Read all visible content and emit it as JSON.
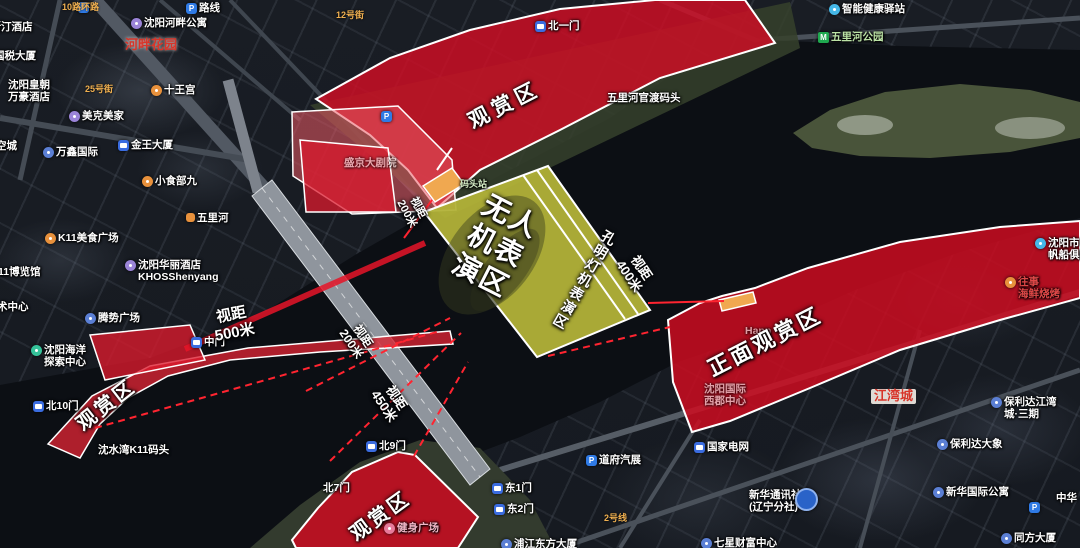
{
  "colors": {
    "viewing_zone_red": "#d20e24",
    "performance_zone_yellow": "#b2b238",
    "sight_line_red": "#ff2430",
    "dock_orange": "#f0a850",
    "red_place_label": "#d8352a"
  },
  "overlay_labels": [
    {
      "name": "viewing-area-top-label",
      "lines": [
        "观赏区"
      ],
      "x": 505,
      "y": 106,
      "rot": -27,
      "size": 21,
      "ls": 5
    },
    {
      "name": "front-viewing-area-label",
      "lines": [
        "正面观赏区"
      ],
      "x": 765,
      "y": 342,
      "rot": -27,
      "size": 22,
      "ls": 3
    },
    {
      "name": "viewing-area-bottom-left-label",
      "lines": [
        "观赏区"
      ],
      "x": 107,
      "y": 406,
      "rot": -38,
      "size": 20,
      "ls": 3
    },
    {
      "name": "viewing-area-bottom-center-label",
      "lines": [
        "观赏区"
      ],
      "x": 381,
      "y": 517,
      "rot": -36,
      "size": 20,
      "ls": 3
    },
    {
      "name": "drone-performance-zone-label",
      "lines": [
        "无人",
        "机表",
        "演区"
      ],
      "x": 496,
      "y": 246,
      "rot": 27,
      "size": 28,
      "ls": 2
    },
    {
      "name": "lantern-performance-zone-label",
      "lines": [
        "孔明灯机表演区"
      ],
      "x": 584,
      "y": 280,
      "rot": 30,
      "size": 14,
      "ls": 2,
      "vert": true
    },
    {
      "name": "sight-distance-500",
      "lines": [
        "视距",
        "500米"
      ],
      "x": 233,
      "y": 324,
      "rot": -11,
      "size": 15
    },
    {
      "name": "sight-distance-200-top",
      "lines": [
        "视距",
        "200米"
      ],
      "x": 412,
      "y": 211,
      "rot": 62,
      "size": 11
    },
    {
      "name": "sight-distance-400",
      "lines": [
        "视距",
        "400米"
      ],
      "x": 635,
      "y": 272,
      "rot": 56,
      "size": 13
    },
    {
      "name": "sight-distance-200-bridge",
      "lines": [
        "视距",
        "200米"
      ],
      "x": 357,
      "y": 340,
      "rot": 56,
      "size": 12
    },
    {
      "name": "sight-distance-450",
      "lines": [
        "视距",
        "450米"
      ],
      "x": 390,
      "y": 402,
      "rot": 56,
      "size": 13
    }
  ],
  "pois": [
    {
      "name": "parking-top-left",
      "label": "",
      "x": 78,
      "y": 1,
      "icon": "parking"
    },
    {
      "name": "route-label",
      "label": "路线",
      "x": 186,
      "y": 2,
      "icon": "parking"
    },
    {
      "name": "road-10-ring",
      "label": "10路环路",
      "x": 62,
      "y": 2,
      "cls": "road"
    },
    {
      "name": "road-12-street",
      "label": "12号街",
      "x": 336,
      "y": 10,
      "cls": "road"
    },
    {
      "name": "riverside-apartment",
      "label": "沈阳河畔公寓",
      "x": 131,
      "y": 17,
      "icon": "circle",
      "ic": "#9b84d8"
    },
    {
      "name": "westin-hotel",
      "label": "威斯汀酒店",
      "x": -20,
      "y": 21
    },
    {
      "name": "hepan-garden",
      "label": "河畔花园",
      "x": 125,
      "y": 38,
      "cls": "red-label"
    },
    {
      "name": "guoshui-building",
      "label": "国税大厦",
      "x": -6,
      "y": 50
    },
    {
      "name": "shiwang-palace",
      "label": "十王宫",
      "x": 151,
      "y": 84,
      "icon": "circle",
      "ic": "#e8913c"
    },
    {
      "name": "huangchao-marriott-hotel",
      "label": "沈阳皇朝",
      "label2": "万豪酒店",
      "x": 8,
      "y": 79
    },
    {
      "name": "meike-meijia",
      "label": "美克美家",
      "x": 69,
      "y": 110,
      "icon": "circle",
      "ic": "#9b84d8"
    },
    {
      "name": "road-25-street",
      "label": "25号街",
      "x": 85,
      "y": 84,
      "cls": "road"
    },
    {
      "name": "wanxin-international",
      "label": "万鑫国际",
      "x": 43,
      "y": 146,
      "icon": "circle",
      "ic": "#5b7fd4"
    },
    {
      "name": "kongcheng-label",
      "label": "空城",
      "x": -4,
      "y": 140
    },
    {
      "name": "jinwang-building",
      "label": "金王大厦",
      "x": 118,
      "y": 139,
      "icon": "bus"
    },
    {
      "name": "xiaoshibu-jiu",
      "label": "小食部九",
      "x": 142,
      "y": 175,
      "icon": "circle",
      "ic": "#e8913c"
    },
    {
      "name": "wulihe-road",
      "label": "五里河",
      "x": 186,
      "y": 212,
      "icon": "roadbadge"
    },
    {
      "name": "k11-food-plaza",
      "label": "K11美食广场",
      "x": 45,
      "y": 232,
      "icon": "circle",
      "ic": "#e8913c"
    },
    {
      "name": "k11-expo-hall",
      "label": "11博览馆",
      "x": -2,
      "y": 266
    },
    {
      "name": "khos-hotel",
      "label": "沈阳华丽酒店",
      "label2": "KHOSShenyang",
      "x": 125,
      "y": 259,
      "icon": "circle",
      "ic": "#9b84d8"
    },
    {
      "name": "k11-art-center",
      "label": "术中心",
      "x": -3,
      "y": 301
    },
    {
      "name": "tengshi-plaza",
      "label": "腾势广场",
      "x": 85,
      "y": 312,
      "icon": "circle",
      "ic": "#5b7fd4"
    },
    {
      "name": "ocean-exploration-center",
      "label": "沈阳海洋",
      "label2": "探索中心",
      "x": 31,
      "y": 344,
      "icon": "circle",
      "ic": "#35c29a"
    },
    {
      "name": "shengjing-theater",
      "label": "盛京大剧院",
      "x": 344,
      "y": 157,
      "cls": "faint"
    },
    {
      "name": "dock-station",
      "label": "码头站",
      "x": 460,
      "y": 179,
      "tc": "#d6eec6",
      "cls": "small"
    },
    {
      "name": "wulihe-ferry-dock",
      "label": "五里河官渡码头",
      "x": 607,
      "y": 92
    },
    {
      "name": "smart-health-station",
      "label": "智能健康驿站",
      "x": 829,
      "y": 3,
      "icon": "circle",
      "ic": "#45b8e8"
    },
    {
      "name": "wulihe-park-metro",
      "label": "五里河公园",
      "x": 818,
      "y": 31,
      "icon": "metro",
      "tc": "#bce3a6"
    },
    {
      "name": "shenshui-bay-k11-dock",
      "label": "沈水湾K11码头",
      "x": 98,
      "y": 444
    },
    {
      "name": "fitness-square",
      "label": "健身广场",
      "x": 384,
      "y": 522,
      "icon": "circle",
      "ic": "#e87a9a",
      "tc": "#f2b6c6"
    },
    {
      "name": "pujiang-oriental-building",
      "label": "浦江东方大厦",
      "x": 501,
      "y": 538,
      "icon": "circle",
      "ic": "#5b7fd4"
    },
    {
      "name": "daofu-auto-show",
      "label": "道府汽展",
      "x": 586,
      "y": 454,
      "icon": "parking"
    },
    {
      "name": "state-grid",
      "label": "国家电网",
      "x": 694,
      "y": 441,
      "icon": "bus"
    },
    {
      "name": "road-line-2",
      "label": "2号线",
      "x": 604,
      "y": 513,
      "cls": "road"
    },
    {
      "name": "xinhua-news-agency",
      "label": "新华通讯社",
      "label2": "(辽宁分社)",
      "x": 749,
      "y": 489
    },
    {
      "name": "xinhua-news-agency-marker",
      "label": "",
      "x": 795,
      "y": 487,
      "icon": "circle-big"
    },
    {
      "name": "seven-star-wealth-center",
      "label": "七星财富中心",
      "x": 701,
      "y": 537,
      "icon": "circle",
      "ic": "#5b7fd4"
    },
    {
      "name": "shenyang-international-xijun-center",
      "label": "沈阳国际",
      "label2": "西郡中心",
      "x": 704,
      "y": 383,
      "cls": "faint"
    },
    {
      "name": "jiangwan-city",
      "label": "江湾城",
      "x": 871,
      "y": 389,
      "cls": "red-label badge"
    },
    {
      "name": "baolida-jiangwan-phase3",
      "label": "保利达江湾",
      "label2": "城·三期",
      "x": 991,
      "y": 396,
      "icon": "circle",
      "ic": "#5b7fd4"
    },
    {
      "name": "baolida-elephant",
      "label": "保利达大象",
      "x": 937,
      "y": 438,
      "icon": "circle",
      "ic": "#5b7fd4"
    },
    {
      "name": "xinhua-international-apartment",
      "label": "新华国际公寓",
      "x": 933,
      "y": 486,
      "icon": "circle",
      "ic": "#5b7fd4"
    },
    {
      "name": "zhonghua-label",
      "label": "中华",
      "x": 1056,
      "y": 492
    },
    {
      "name": "tongfang-building",
      "label": "同方大厦",
      "x": 1001,
      "y": 532,
      "icon": "circle",
      "ic": "#5b7fd4"
    },
    {
      "name": "parking-bottom-right",
      "label": "",
      "x": 1029,
      "y": 501,
      "icon": "parking"
    },
    {
      "name": "sailing-club",
      "label": "沈阳市",
      "label2": "帆船俱乐部",
      "x": 1035,
      "y": 237,
      "icon": "circle",
      "ic": "#45b8e8"
    },
    {
      "name": "seafood-bbq-restaurant",
      "label": "往事",
      "label2": "海鲜烧烤",
      "x": 1005,
      "y": 276,
      "icon": "circle",
      "ic": "#e8913c",
      "tc": "#e04848"
    },
    {
      "name": "happ-watermark",
      "label": "Happ",
      "x": 745,
      "y": 325,
      "cls": "faint"
    },
    {
      "name": "parking-theater",
      "label": "",
      "x": 381,
      "y": 110,
      "icon": "parking"
    },
    {
      "name": "gate-north-1",
      "label": "北一门",
      "x": 535,
      "y": 20,
      "icon": "bus"
    },
    {
      "name": "gate-middle",
      "label": "中门",
      "x": 191,
      "y": 336,
      "icon": "bus"
    },
    {
      "name": "gate-north-10",
      "label": "北10门",
      "x": 33,
      "y": 400,
      "icon": "bus"
    },
    {
      "name": "gate-north-9",
      "label": "北9门",
      "x": 366,
      "y": 440,
      "icon": "bus"
    },
    {
      "name": "gate-north-7",
      "label": "北7门",
      "x": 323,
      "y": 482
    },
    {
      "name": "gate-east-1",
      "label": "东1门",
      "x": 492,
      "y": 482,
      "icon": "bus"
    },
    {
      "name": "gate-east-2",
      "label": "东2门",
      "x": 494,
      "y": 503,
      "icon": "bus"
    }
  ]
}
